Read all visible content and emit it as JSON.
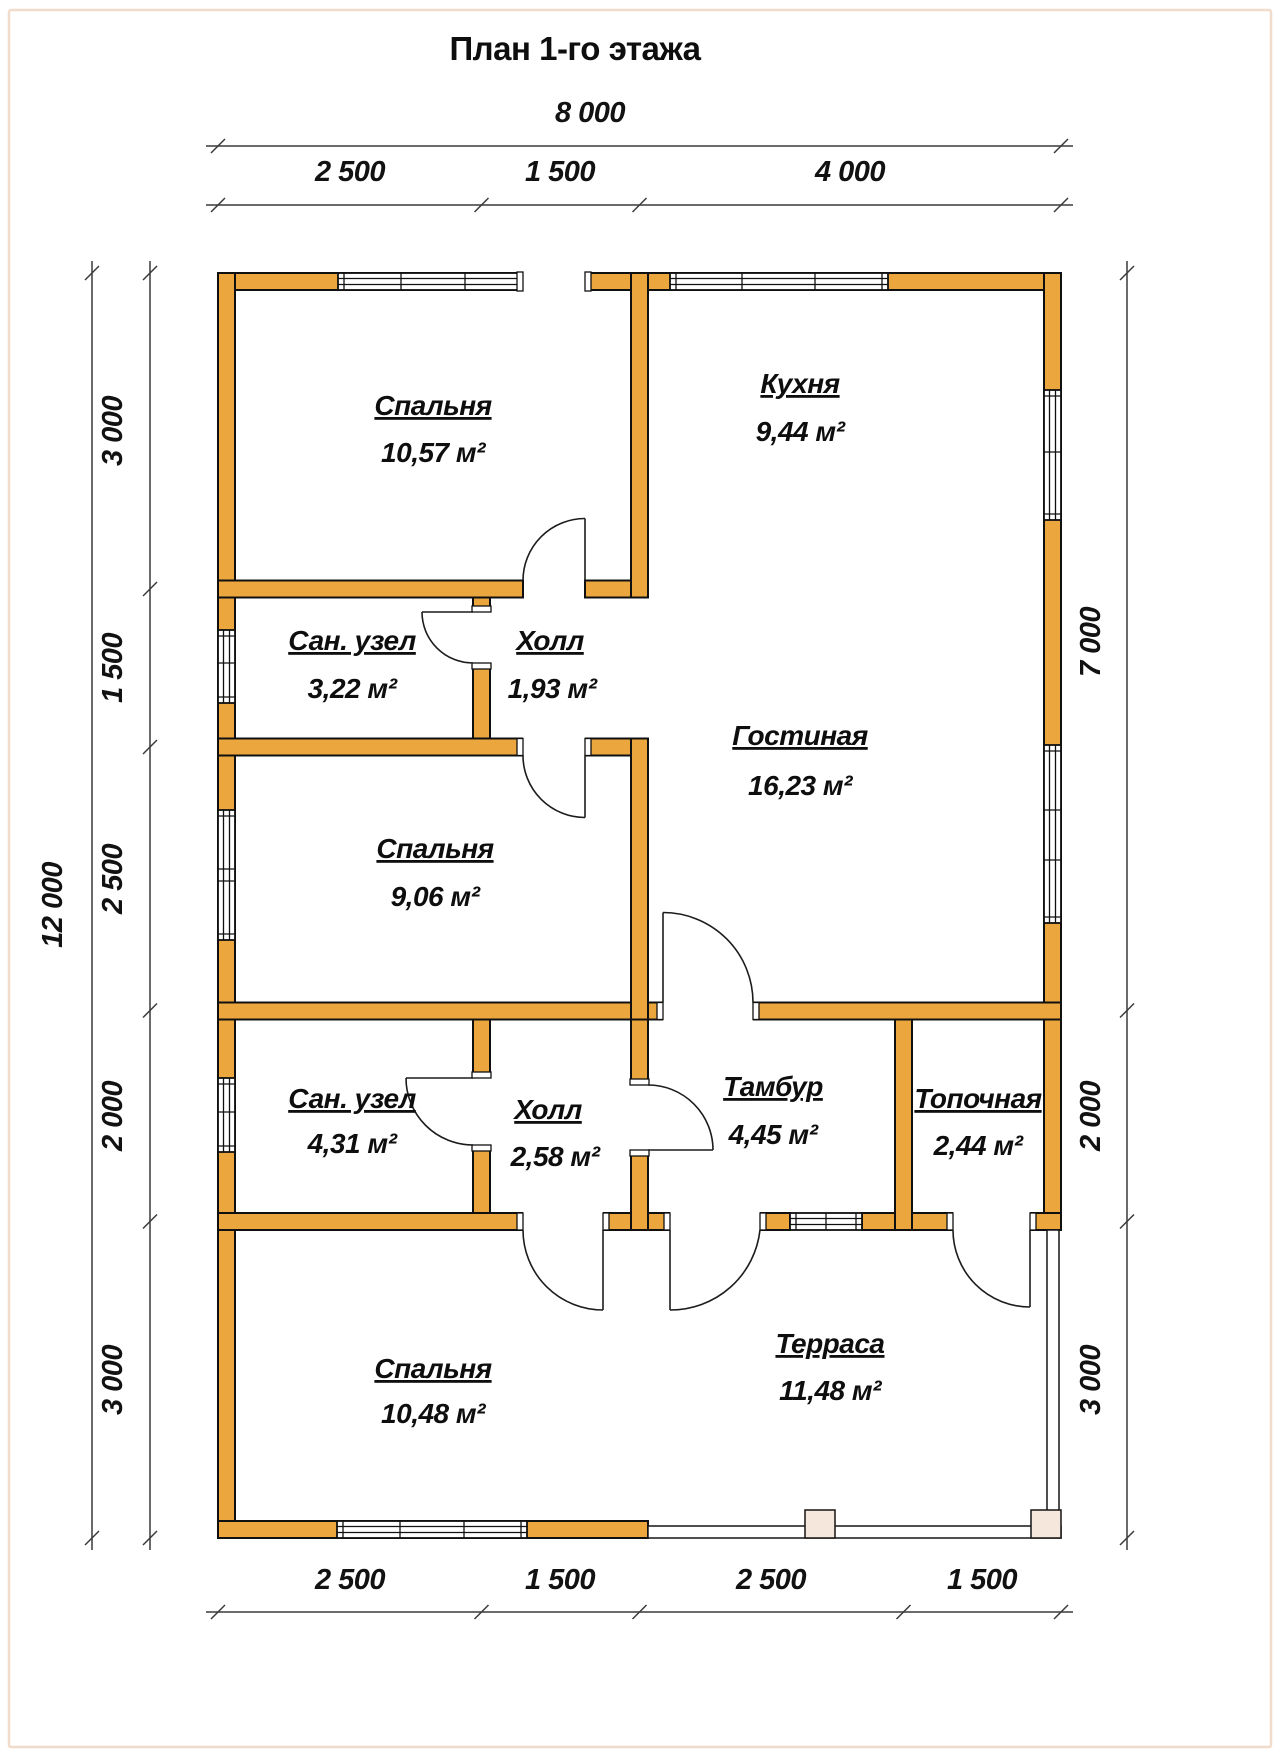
{
  "title": "План 1-го этажа",
  "colors": {
    "wall": "#EBA73E",
    "outline": "#101010",
    "dimension": "#3a3a3a",
    "page_border": "#F1DBCA",
    "terrace_post": "#F5E7DB"
  },
  "rooms": [
    {
      "name": "Спальня",
      "area": "10,57 м²"
    },
    {
      "name": "Кухня",
      "area": "9,44 м²"
    },
    {
      "name": "Сан. узел",
      "area": "3,22 м²"
    },
    {
      "name": "Холл",
      "area": "1,93 м²"
    },
    {
      "name": "Гостиная",
      "area": "16,23 м²"
    },
    {
      "name": "Спальня",
      "area": "9,06 м²"
    },
    {
      "name": "Сан. узел",
      "area": "4,31 м²"
    },
    {
      "name": "Холл",
      "area": "2,58 м²"
    },
    {
      "name": "Тамбур",
      "area": "4,45 м²"
    },
    {
      "name": "Топочная",
      "area": "2,44 м²"
    },
    {
      "name": "Спальня",
      "area": "10,48 м²"
    },
    {
      "name": "Терраса",
      "area": "11,48 м²"
    }
  ],
  "dims": {
    "top_total": "8 000",
    "top": [
      "2 500",
      "1 500",
      "4 000"
    ],
    "bottom": [
      "2 500",
      "1 500",
      "2 500",
      "1 500"
    ],
    "left_total": "12 000",
    "left": [
      "3 000",
      "1 500",
      "2 500",
      "2 000",
      "3 000"
    ],
    "right": [
      "7 000",
      "2 000",
      "3 000"
    ]
  }
}
